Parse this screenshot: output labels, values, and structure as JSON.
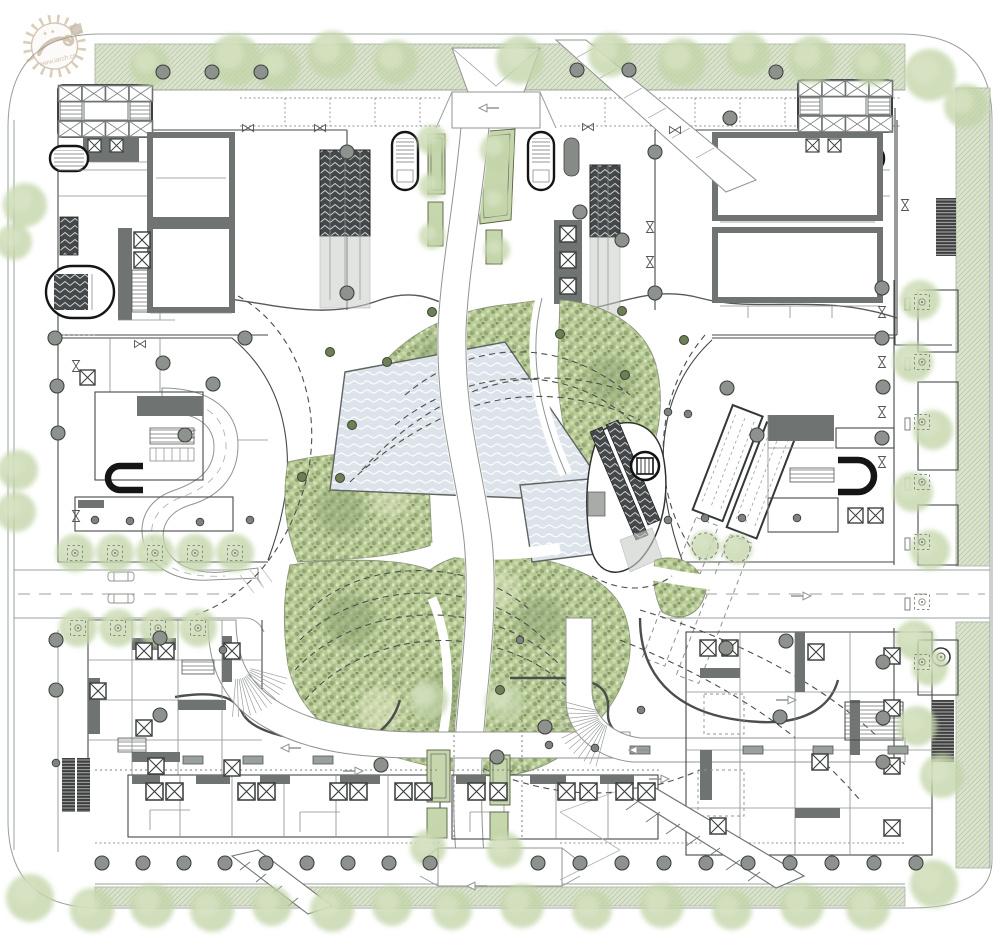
{
  "document": {
    "title": "Ground-level master plan drawing"
  },
  "watermark": {
    "url": "www.iarch.cn"
  },
  "palette": {
    "background": "#ffffff",
    "line_light": "#9aa09c",
    "line_dark": "#44484a",
    "wall_poche": "#6f7472",
    "column_fill": "#8d928e",
    "green_band": "#dce4d0",
    "green_band_hatch": "#b9c8a6",
    "canopy": "#c3d5a9",
    "park_base": "#b9cb96",
    "park_speckle_dark": "#8fa572",
    "park_speckle_light": "#d7e0bb",
    "water": "#dce3ea",
    "water_wave": "#ffffff",
    "bed_green": "#c6d6ad",
    "escalator_dark": "#45484a",
    "watermark_tan": "#b3997a"
  },
  "drawing": {
    "columns": [
      [
        163,
        72
      ],
      [
        212,
        72
      ],
      [
        261,
        72
      ],
      [
        577,
        70
      ],
      [
        629,
        70
      ],
      [
        776,
        72
      ],
      [
        730,
        118
      ],
      [
        347,
        152
      ],
      [
        347,
        293
      ],
      [
        655,
        152
      ],
      [
        655,
        293
      ],
      [
        622,
        240
      ],
      [
        580,
        212
      ],
      [
        163,
        363
      ],
      [
        213,
        384
      ],
      [
        185,
        435
      ],
      [
        245,
        338
      ],
      [
        55,
        338
      ],
      [
        57,
        386
      ],
      [
        58,
        433
      ],
      [
        727,
        388
      ],
      [
        757,
        435
      ],
      [
        883,
        387
      ],
      [
        882,
        288
      ],
      [
        882,
        338
      ],
      [
        882,
        438
      ],
      [
        56,
        640
      ],
      [
        56,
        690
      ],
      [
        160,
        638
      ],
      [
        160,
        715
      ],
      [
        381,
        765
      ],
      [
        497,
        757
      ],
      [
        545,
        727
      ],
      [
        786,
        641
      ],
      [
        780,
        717
      ],
      [
        726,
        648
      ],
      [
        883,
        662
      ],
      [
        883,
        718
      ],
      [
        883,
        762
      ],
      [
        102,
        863
      ],
      [
        143,
        863
      ],
      [
        184,
        863
      ],
      [
        225,
        863
      ],
      [
        266,
        863
      ],
      [
        307,
        863
      ],
      [
        348,
        863
      ],
      [
        389,
        863
      ],
      [
        430,
        863
      ],
      [
        538,
        863
      ],
      [
        580,
        863
      ],
      [
        622,
        863
      ],
      [
        664,
        863
      ],
      [
        706,
        863
      ],
      [
        748,
        863
      ],
      [
        790,
        863
      ],
      [
        832,
        863
      ],
      [
        874,
        863
      ],
      [
        916,
        863
      ]
    ],
    "small_columns": [
      [
        95,
        520
      ],
      [
        130,
        521
      ],
      [
        200,
        522
      ],
      [
        250,
        520
      ],
      [
        668,
        520
      ],
      [
        705,
        518
      ],
      [
        742,
        518
      ],
      [
        797,
        518
      ],
      [
        668,
        412
      ],
      [
        688,
        414
      ],
      [
        56,
        763
      ],
      [
        223,
        650
      ],
      [
        520,
        640
      ],
      [
        595,
        748
      ],
      [
        641,
        710
      ],
      [
        549,
        745
      ]
    ],
    "park_dots": [
      [
        330,
        352
      ],
      [
        387,
        362
      ],
      [
        560,
        334
      ],
      [
        622,
        311
      ],
      [
        684,
        340
      ],
      [
        352,
        425
      ],
      [
        302,
        477
      ],
      [
        340,
        478
      ],
      [
        625,
        375
      ],
      [
        500,
        690
      ],
      [
        432,
        312
      ]
    ],
    "canopies": [
      [
        150,
        66,
        20
      ],
      [
        235,
        60,
        26
      ],
      [
        278,
        68,
        22
      ],
      [
        332,
        55,
        24
      ],
      [
        396,
        62,
        22
      ],
      [
        520,
        60,
        24
      ],
      [
        610,
        55,
        22
      ],
      [
        682,
        62,
        24
      ],
      [
        748,
        55,
        22
      ],
      [
        812,
        60,
        24
      ],
      [
        872,
        66,
        20
      ],
      [
        25,
        205,
        22
      ],
      [
        14,
        242,
        18
      ],
      [
        930,
        75,
        26
      ],
      [
        966,
        106,
        22
      ],
      [
        18,
        470,
        20
      ],
      [
        16,
        512,
        20
      ],
      [
        920,
        300,
        20
      ],
      [
        913,
        362,
        20
      ],
      [
        933,
        430,
        20
      ],
      [
        913,
        492,
        20
      ],
      [
        930,
        550,
        20
      ],
      [
        915,
        640,
        20
      ],
      [
        930,
        668,
        18
      ],
      [
        917,
        726,
        20
      ],
      [
        942,
        776,
        22
      ],
      [
        75,
        553,
        19
      ],
      [
        115,
        553,
        19
      ],
      [
        155,
        553,
        19
      ],
      [
        195,
        553,
        19
      ],
      [
        235,
        553,
        19
      ],
      [
        78,
        628,
        19
      ],
      [
        118,
        628,
        19
      ],
      [
        158,
        628,
        19
      ],
      [
        198,
        628,
        19
      ],
      [
        30,
        898,
        24
      ],
      [
        92,
        910,
        22
      ],
      [
        152,
        906,
        22
      ],
      [
        212,
        910,
        22
      ],
      [
        272,
        906,
        20
      ],
      [
        332,
        910,
        22
      ],
      [
        392,
        906,
        20
      ],
      [
        452,
        910,
        20
      ],
      [
        522,
        906,
        22
      ],
      [
        592,
        910,
        20
      ],
      [
        662,
        906,
        22
      ],
      [
        732,
        910,
        20
      ],
      [
        802,
        906,
        22
      ],
      [
        868,
        908,
        22
      ],
      [
        934,
        884,
        24
      ],
      [
        428,
        700,
        20
      ],
      [
        505,
        702,
        20
      ],
      [
        428,
        848,
        18
      ],
      [
        505,
        850,
        18
      ],
      [
        432,
        140,
        15
      ],
      [
        432,
        186,
        13
      ],
      [
        497,
        150,
        17
      ],
      [
        497,
        202,
        15
      ],
      [
        432,
        236,
        13
      ],
      [
        497,
        250,
        13
      ],
      [
        705,
        546,
        15
      ],
      [
        737,
        549,
        15
      ]
    ],
    "tree_pits": [
      [
        75,
        553
      ],
      [
        115,
        553
      ],
      [
        155,
        553
      ],
      [
        195,
        553
      ],
      [
        235,
        553
      ],
      [
        78,
        628
      ],
      [
        118,
        628
      ],
      [
        158,
        628
      ],
      [
        198,
        628
      ],
      [
        922,
        302
      ],
      [
        922,
        362
      ],
      [
        922,
        422
      ],
      [
        922,
        482
      ],
      [
        922,
        542
      ],
      [
        922,
        602
      ],
      [
        922,
        662
      ]
    ],
    "pit_circles": [
      [
        705,
        546
      ],
      [
        737,
        549
      ]
    ],
    "bowties": [
      [
        248,
        128,
        0
      ],
      [
        320,
        128,
        0
      ],
      [
        588,
        127,
        0
      ],
      [
        675,
        130,
        0
      ],
      [
        650,
        227,
        90
      ],
      [
        650,
        262,
        90
      ],
      [
        882,
        312,
        90
      ],
      [
        882,
        362,
        90
      ],
      [
        882,
        412,
        90
      ],
      [
        882,
        462,
        90
      ],
      [
        76,
        366,
        90
      ],
      [
        76,
        516,
        90
      ],
      [
        140,
        344,
        0
      ],
      [
        905,
        205,
        90
      ]
    ],
    "slabs": [
      [
        193,
        760
      ],
      [
        253,
        760
      ],
      [
        323,
        760
      ],
      [
        640,
        750
      ],
      [
        753,
        750
      ],
      [
        823,
        750
      ],
      [
        898,
        750
      ]
    ],
    "xboxes": [
      [
        134,
        232,
        16
      ],
      [
        134,
        252,
        16
      ],
      [
        560,
        226,
        16
      ],
      [
        560,
        252,
        16
      ],
      [
        560,
        278,
        16
      ],
      [
        88,
        139,
        13
      ],
      [
        110,
        139,
        13
      ],
      [
        806,
        139,
        13
      ],
      [
        828,
        139,
        13
      ],
      [
        136,
        643,
        16
      ],
      [
        158,
        643,
        16
      ],
      [
        90,
        683,
        16
      ],
      [
        136,
        720,
        16
      ],
      [
        224,
        643,
        16
      ],
      [
        148,
        758,
        16
      ],
      [
        224,
        760,
        16
      ],
      [
        146,
        783,
        17
      ],
      [
        166,
        783,
        17
      ],
      [
        238,
        783,
        17
      ],
      [
        258,
        783,
        17
      ],
      [
        330,
        783,
        17
      ],
      [
        350,
        783,
        17
      ],
      [
        395,
        783,
        17
      ],
      [
        415,
        783,
        17
      ],
      [
        468,
        783,
        17
      ],
      [
        490,
        783,
        17
      ],
      [
        558,
        783,
        17
      ],
      [
        580,
        783,
        17
      ],
      [
        616,
        783,
        17
      ],
      [
        638,
        783,
        17
      ],
      [
        700,
        640,
        16
      ],
      [
        722,
        640,
        16
      ],
      [
        808,
        644,
        16
      ],
      [
        884,
        648,
        16
      ],
      [
        884,
        700,
        16
      ],
      [
        812,
        754,
        16
      ],
      [
        884,
        758,
        16
      ],
      [
        710,
        818,
        16
      ],
      [
        884,
        820,
        16
      ],
      [
        848,
        508,
        15
      ],
      [
        868,
        508,
        15
      ],
      [
        80,
        370,
        15
      ]
    ],
    "fans": [
      {
        "cx": 237,
        "cy": 665,
        "r0": 14,
        "r1": 52,
        "a0": 15,
        "a1": 95,
        "n": 13
      },
      {
        "cx": 610,
        "cy": 714,
        "r0": 12,
        "r1": 54,
        "a0": 105,
        "a1": 195,
        "n": 14
      }
    ],
    "arrows": [
      [
        292,
        748,
        -1
      ],
      [
        352,
        771,
        1
      ],
      [
        640,
        750,
        -1
      ],
      [
        658,
        779,
        1
      ],
      [
        785,
        700,
        1
      ],
      [
        800,
        596,
        1
      ],
      [
        490,
        108,
        -1
      ],
      [
        478,
        886,
        -1
      ]
    ]
  }
}
